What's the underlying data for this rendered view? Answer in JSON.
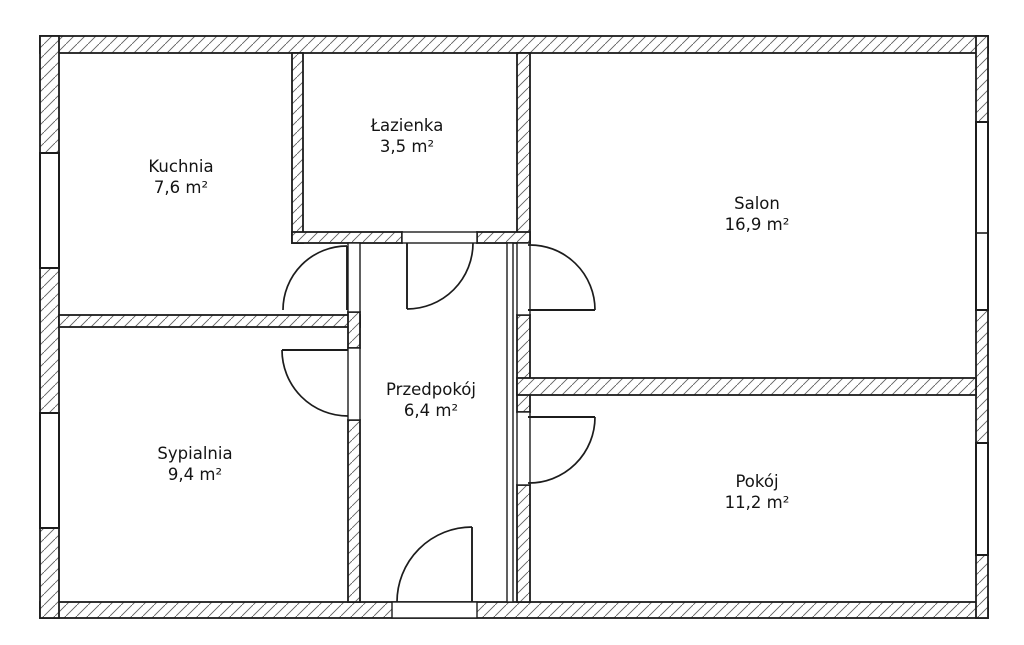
{
  "document_title": "Rzut mieszkania",
  "colors": {
    "background": "#ffffff",
    "wall_stroke": "#1c1c1c",
    "hatch_line": "#5f5f5f",
    "text": "#141414"
  },
  "rooms": [
    {
      "name": "kuchnia",
      "label": "Kuchnia",
      "area": "7,6 m²",
      "cx": 181,
      "cy": 172
    },
    {
      "name": "lazienka",
      "label": "Łazienka",
      "area": "3,5 m²",
      "cx": 407,
      "cy": 131
    },
    {
      "name": "salon",
      "label": "Salon",
      "area": "16,9 m²",
      "cx": 757,
      "cy": 209
    },
    {
      "name": "sypialnia",
      "label": "Sypialnia",
      "area": "9,4 m²",
      "cx": 195,
      "cy": 459
    },
    {
      "name": "przedpokoj",
      "label": "Przedpokój",
      "area": "6,4 m²",
      "cx": 431,
      "cy": 395
    },
    {
      "name": "pokoj",
      "label": "Pokój",
      "area": "11,2 m²",
      "cx": 757,
      "cy": 487
    }
  ],
  "plan": {
    "canvas": {
      "w": 1024,
      "h": 645
    },
    "walls_hatched": [
      {
        "name": "outer-wall-top",
        "r": [
          40,
          36,
          948,
          17
        ]
      },
      {
        "name": "outer-wall-bottom",
        "r": [
          40,
          602,
          948,
          16
        ]
      },
      {
        "name": "outer-wall-left",
        "r": [
          40,
          36,
          19,
          582
        ]
      },
      {
        "name": "outer-wall-right",
        "r": [
          976,
          36,
          12,
          582
        ]
      },
      {
        "name": "wall-lazienka-left",
        "r": [
          292,
          53,
          11,
          190
        ]
      },
      {
        "name": "wall-lazienka-right",
        "r": [
          517,
          53,
          13,
          190
        ]
      },
      {
        "name": "wall-lazienka-bottom-left",
        "r": [
          292,
          232,
          110,
          11
        ]
      },
      {
        "name": "wall-lazienka-bottom-right",
        "r": [
          477,
          232,
          53,
          11
        ]
      },
      {
        "name": "wall-kuchnia-sypialnia",
        "r": [
          59,
          315,
          301,
          12
        ]
      },
      {
        "name": "wall-hall-left-mid",
        "r": [
          348,
          312,
          12,
          36
        ]
      },
      {
        "name": "wall-hall-left-lower",
        "r": [
          348,
          420,
          12,
          182
        ]
      },
      {
        "name": "wall-salon-west-mid",
        "r": [
          517,
          315,
          13,
          97
        ]
      },
      {
        "name": "wall-salon-west-lower",
        "r": [
          517,
          485,
          13,
          117
        ]
      },
      {
        "name": "wall-salon-pokoj-divider",
        "r": [
          517,
          378,
          459,
          17
        ]
      }
    ],
    "openings": [
      {
        "name": "opening-lazienka-door",
        "r": [
          402,
          232,
          75,
          11
        ]
      },
      {
        "name": "opening-kuchnia-door",
        "r": [
          348,
          243,
          12,
          69
        ]
      },
      {
        "name": "opening-sypialnia-door",
        "r": [
          348,
          348,
          12,
          72
        ]
      },
      {
        "name": "opening-salon-door",
        "r": [
          517,
          243,
          13,
          72
        ]
      },
      {
        "name": "opening-pokoj-door",
        "r": [
          517,
          412,
          13,
          73
        ]
      },
      {
        "name": "opening-entrance-door",
        "r": [
          392,
          602,
          85,
          16
        ]
      },
      {
        "name": "wall-hall-thin-right",
        "r": [
          507,
          243,
          6,
          359
        ]
      }
    ],
    "windows": [
      {
        "name": "window-kuchnia",
        "r": [
          40,
          153,
          19,
          115
        ]
      },
      {
        "name": "window-sypialnia",
        "r": [
          40,
          413,
          19,
          115
        ]
      },
      {
        "name": "window-salon",
        "r": [
          976,
          122,
          12,
          188
        ]
      },
      {
        "name": "window-pokoj",
        "r": [
          976,
          443,
          12,
          112
        ]
      }
    ],
    "mullions": [
      {
        "name": "window-salon-mullion",
        "line": [
          976,
          233,
          988,
          233
        ]
      }
    ],
    "door_leaves": [
      {
        "name": "door-leaf-lazienka",
        "line": [
          407,
          243,
          407,
          309
        ]
      },
      {
        "name": "door-leaf-kuchnia",
        "line": [
          347,
          246,
          347,
          310
        ]
      },
      {
        "name": "door-leaf-sypialnia",
        "line": [
          282,
          350,
          348,
          350
        ]
      },
      {
        "name": "door-leaf-salon",
        "line": [
          528,
          310,
          595,
          310
        ]
      },
      {
        "name": "door-leaf-pokoj",
        "line": [
          528,
          417,
          595,
          417
        ]
      },
      {
        "name": "door-leaf-entrance",
        "line": [
          472,
          527,
          472,
          602
        ]
      }
    ],
    "door_arcs": [
      {
        "name": "door-arc-lazienka",
        "d": "M407,309 A66,66 0 0 0 473,243"
      },
      {
        "name": "door-arc-kuchnia",
        "d": "M283,310 A64,64 0 0 1 347,246"
      },
      {
        "name": "door-arc-sypialnia",
        "d": "M282,350 A66,66 0 0 0 348,416"
      },
      {
        "name": "door-arc-salon",
        "d": "M528,245 A65,65 0 0 1 595,310"
      },
      {
        "name": "door-arc-pokoj",
        "d": "M595,417 A66,66 0 0 1 528,483"
      },
      {
        "name": "door-arc-entrance",
        "d": "M397,602 A75,75 0 0 1 472,527"
      }
    ]
  }
}
